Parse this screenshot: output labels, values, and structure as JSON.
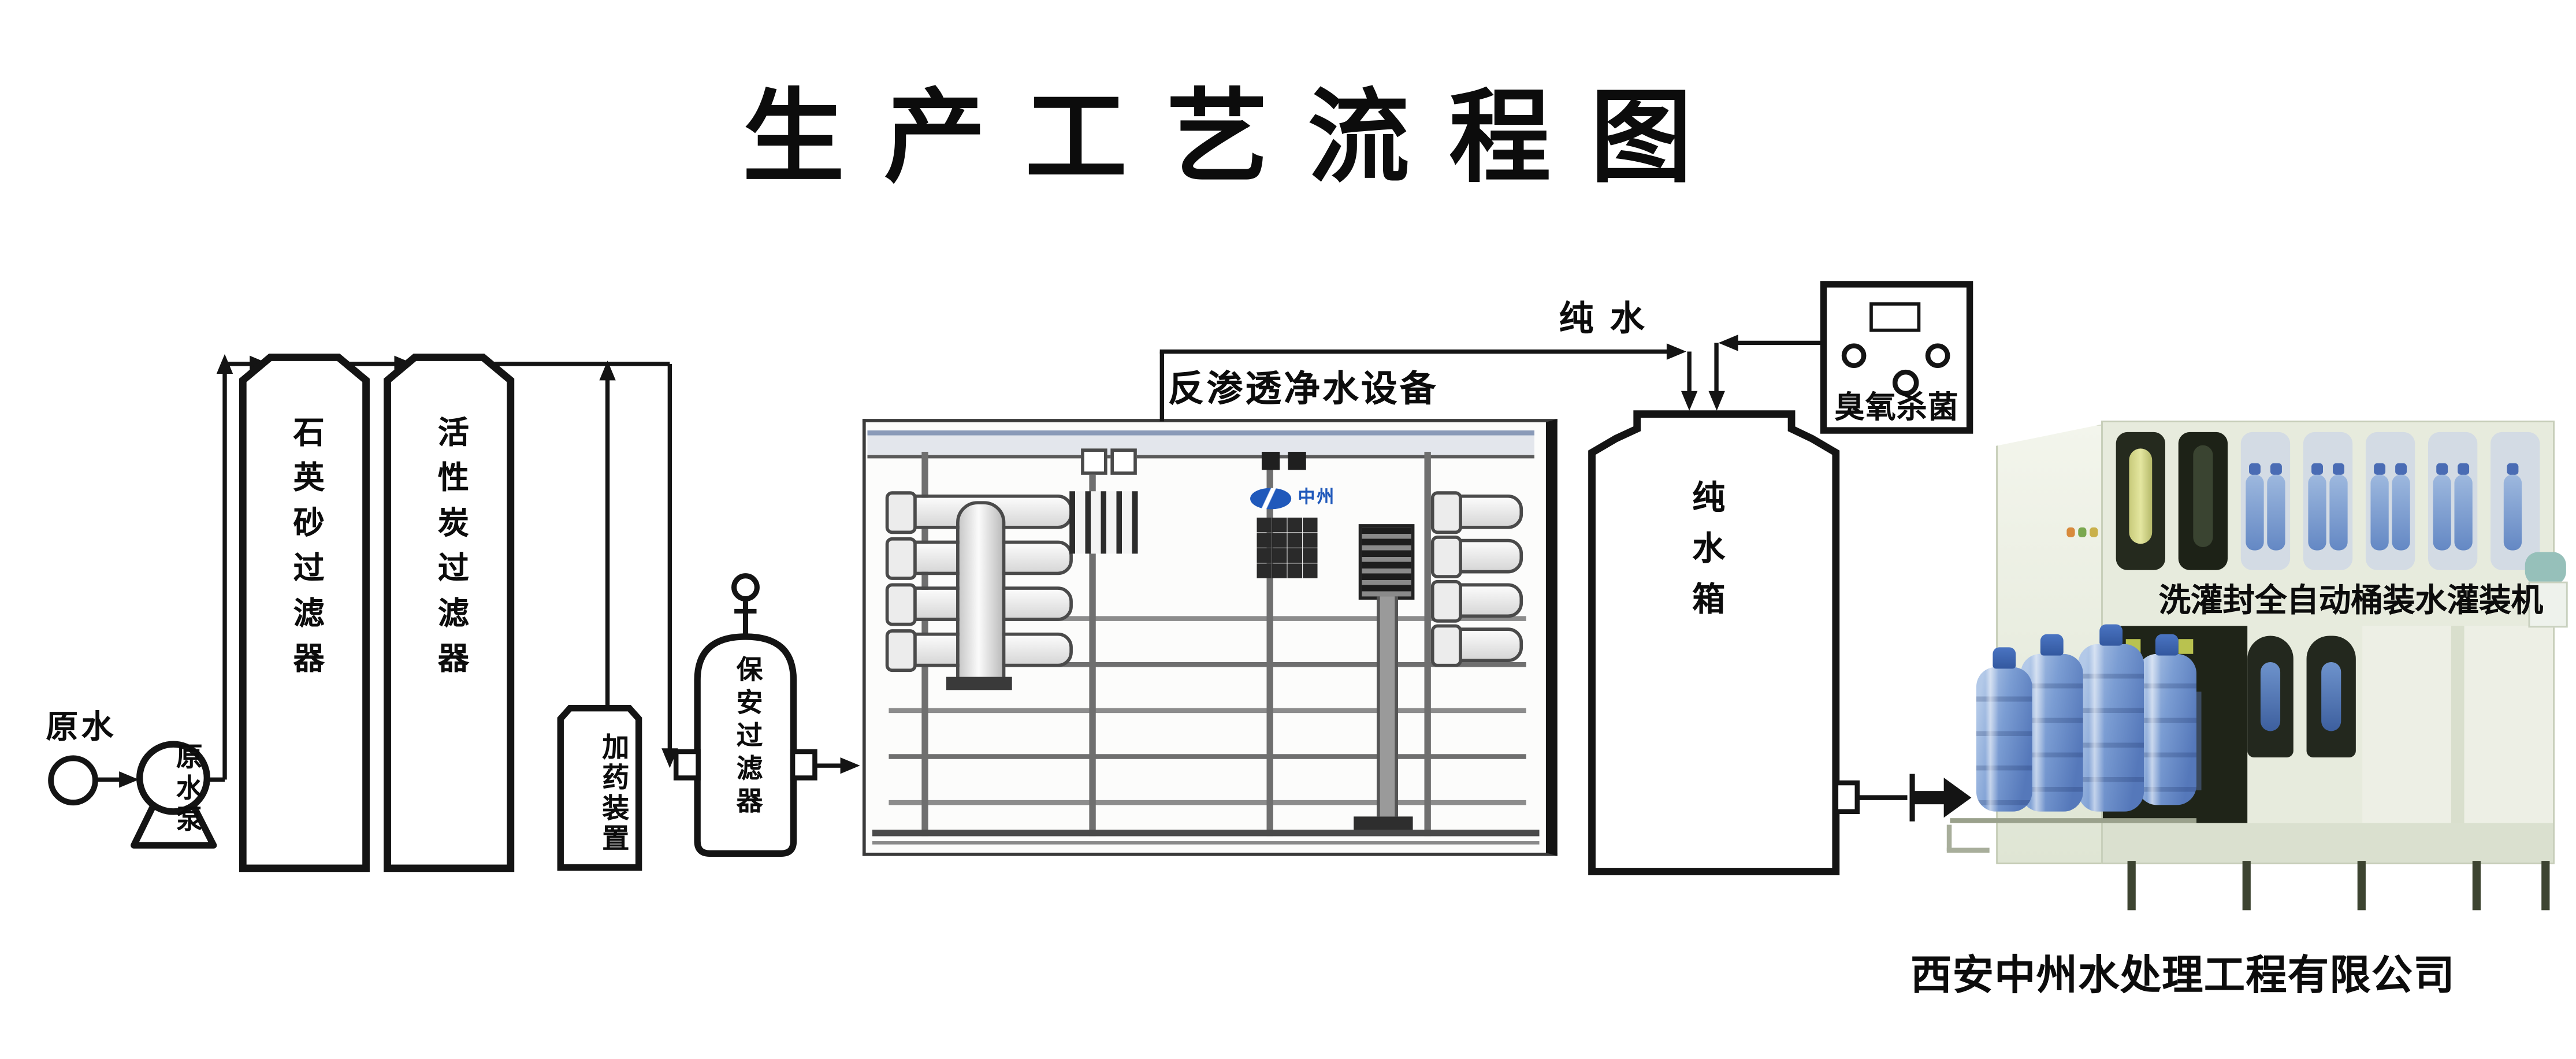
{
  "title": "生产工艺流程图",
  "company": "西安中州水处理工程有限公司",
  "labels": {
    "raw_water": "原水",
    "raw_water_pump": "原水泵",
    "quartz_filter": "石英砂过滤器",
    "carbon_filter": "活性炭过滤器",
    "dosing_device": "加药装置",
    "security_filter": "保安过滤器",
    "ro_equipment": "反渗透净水设备",
    "pure_water": "纯水",
    "ozone": "臭氧杀菌",
    "pure_water_tank": "纯水箱",
    "filling_machine": "洗灌封全自动桶装水灌装机",
    "brand": "中州"
  },
  "colors": {
    "line": "#141414",
    "brand_blue": "#2059bb",
    "bottle_blue": "#6d93cc",
    "machine_body": "#e7ebdd",
    "machine_window_dark": "#242a1e",
    "yellow_cylinder": "#d6d98a",
    "teal_unit": "#96c0ba"
  }
}
